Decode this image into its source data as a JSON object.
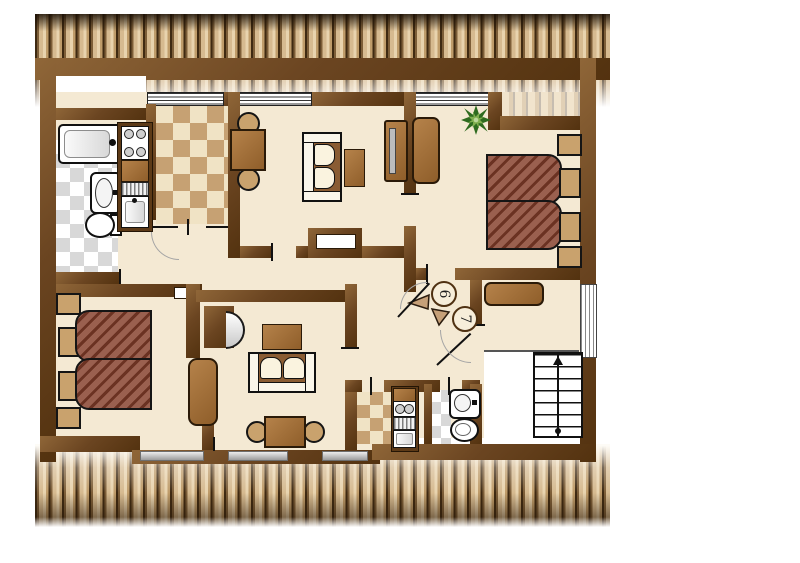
{
  "title": "attic floor plan",
  "markers": [
    {
      "label": "6"
    },
    {
      "label": "7"
    }
  ],
  "stairs": {
    "direction": "up"
  },
  "palette": {
    "wall_brown": "#6b4521",
    "wall_highlight": "#8f6638",
    "floor_cream": "#f4e9d3",
    "roof_stripe_light": "#e8d3ae",
    "roof_stripe_dark": "#3f2a12",
    "tile_tan": "#c6a173",
    "tile_cream": "#f0e3c5",
    "tile_white": "#ffffff",
    "tile_gray": "#d8d8d8",
    "furniture_wood": "#a9763d",
    "nightstand_tan": "#c9a26d",
    "mattress_red": "#9a604f",
    "plant_green": "#2e6b1f",
    "sill_gray": "#b9b9b9",
    "marker_ring": "#4f3112"
  }
}
